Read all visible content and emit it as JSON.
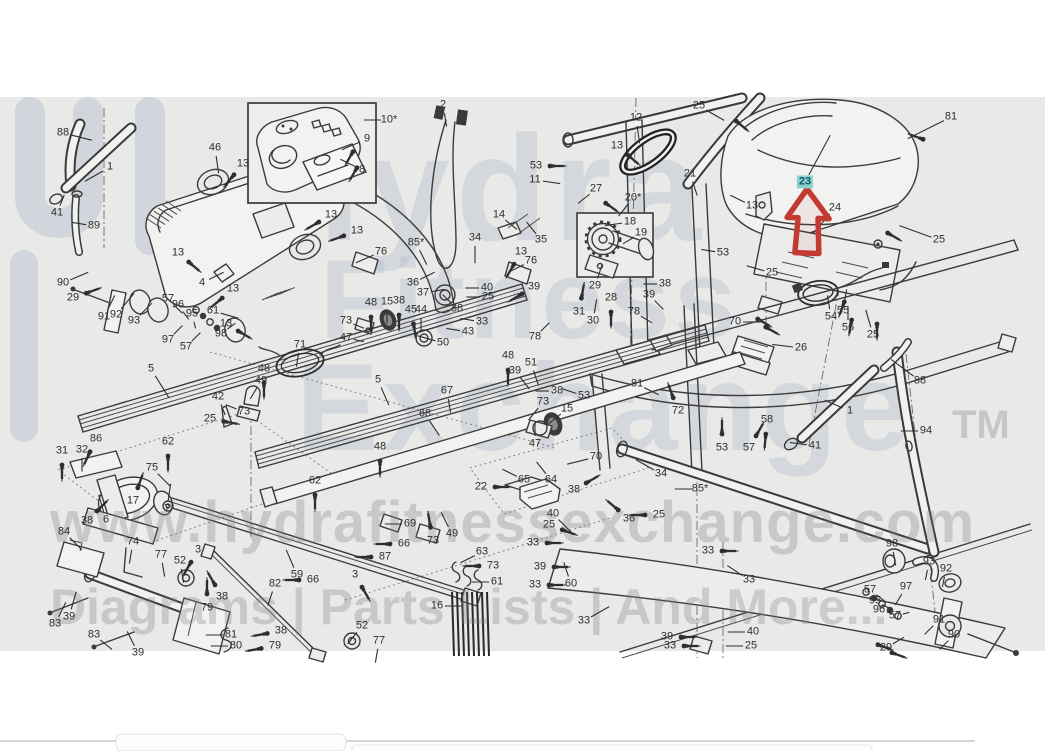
{
  "watermark": {
    "line1": "Hydra",
    "line2": "Fitness",
    "line3": "Exchange",
    "tm": "TM",
    "url": "www.hydrafitnessexchange.com",
    "tagline": "Diagrams | Parts Lists | And More..."
  },
  "highlight": {
    "part": "23",
    "arrow_color": "#c23a31",
    "highlight_bg": "#8bd0cd",
    "highlight_text": "#14586e"
  },
  "colors": {
    "canvas": "#e9e9e7",
    "page": "#ffffff",
    "line": "#3b3b3b",
    "label": "#2e2e2e"
  },
  "callouts": [
    {
      "t": "88",
      "x": 63,
      "y": 133,
      "l": [
        16,
        4
      ]
    },
    {
      "t": "1",
      "x": 110,
      "y": 167,
      "l": [
        -14,
        8
      ]
    },
    {
      "t": "41",
      "x": 57,
      "y": 213,
      "l": [
        4,
        -10
      ]
    },
    {
      "t": "89",
      "x": 94,
      "y": 226,
      "l": [
        -12,
        -2
      ]
    },
    {
      "t": "46",
      "x": 215,
      "y": 148,
      "l": [
        2,
        14
      ]
    },
    {
      "t": "13",
      "x": 243,
      "y": 164,
      "s": 130
    },
    {
      "t": "13",
      "x": 331,
      "y": 215,
      "s": 150
    },
    {
      "t": "13",
      "x": 357,
      "y": 231,
      "s": 160
    },
    {
      "t": "76",
      "x": 381,
      "y": 252,
      "l": [
        -14,
        6
      ]
    },
    {
      "t": "13",
      "x": 178,
      "y": 253,
      "s": 40
    },
    {
      "t": "4",
      "x": 202,
      "y": 283,
      "l": [
        12,
        -6
      ]
    },
    {
      "t": "13",
      "x": 233,
      "y": 289,
      "s": 140
    },
    {
      "t": "61",
      "x": 213,
      "y": 311,
      "l": [
        14,
        4
      ]
    },
    {
      "t": "13",
      "x": 226,
      "y": 324,
      "s": 30
    },
    {
      "t": "10*",
      "x": 389,
      "y": 120,
      "l": [
        -14,
        0
      ]
    },
    {
      "t": "9",
      "x": 367,
      "y": 139,
      "l": [
        -14,
        6
      ]
    },
    {
      "t": "8",
      "x": 362,
      "y": 170,
      "l": [
        -12,
        -6
      ]
    },
    {
      "t": "2",
      "x": 443,
      "y": 105,
      "l": [
        2,
        12
      ]
    },
    {
      "t": "90",
      "x": 63,
      "y": 283,
      "l": [
        14,
        -6
      ]
    },
    {
      "t": "29",
      "x": 73,
      "y": 298,
      "s": -20
    },
    {
      "t": "91",
      "x": 104,
      "y": 317,
      "l": [
        6,
        -12
      ]
    },
    {
      "t": "92",
      "x": 116,
      "y": 315,
      "l": [
        10,
        -12
      ]
    },
    {
      "t": "93",
      "x": 134,
      "y": 321,
      "l": [
        10,
        -10
      ]
    },
    {
      "t": "57",
      "x": 168,
      "y": 299,
      "l": [
        8,
        8
      ]
    },
    {
      "t": "96",
      "x": 178,
      "y": 305,
      "l": [
        6,
        8
      ]
    },
    {
      "t": "95",
      "x": 192,
      "y": 314,
      "l": [
        2,
        8
      ]
    },
    {
      "t": "97",
      "x": 168,
      "y": 340,
      "l": [
        8,
        -8
      ]
    },
    {
      "t": "57",
      "x": 186,
      "y": 347,
      "l": [
        8,
        -8
      ]
    },
    {
      "t": "98",
      "x": 221,
      "y": 334,
      "l": [
        8,
        -6
      ]
    },
    {
      "t": "5",
      "x": 151,
      "y": 369,
      "l": [
        10,
        16
      ]
    },
    {
      "t": "71",
      "x": 300,
      "y": 345,
      "l": [
        -2,
        12
      ]
    },
    {
      "t": "48",
      "x": 264,
      "y": 369,
      "s": 90
    },
    {
      "t": "49",
      "x": 261,
      "y": 381,
      "l": [
        -6,
        10
      ]
    },
    {
      "t": "42",
      "x": 218,
      "y": 397,
      "l": [
        4,
        10
      ]
    },
    {
      "t": "73",
      "x": 244,
      "y": 412,
      "l": [
        -10,
        -4
      ]
    },
    {
      "t": "25",
      "x": 210,
      "y": 419,
      "s": 10
    },
    {
      "t": "62",
      "x": 168,
      "y": 442,
      "s": 90
    },
    {
      "t": "86",
      "x": 96,
      "y": 439,
      "s": 115
    },
    {
      "t": "31",
      "x": 62,
      "y": 451,
      "s": 90
    },
    {
      "t": "32",
      "x": 82,
      "y": 450,
      "l": [
        0,
        12
      ]
    },
    {
      "t": "75",
      "x": 152,
      "y": 468,
      "l": [
        10,
        10
      ]
    },
    {
      "t": "17",
      "x": 133,
      "y": 501,
      "s": -70
    },
    {
      "t": "38",
      "x": 87,
      "y": 521,
      "s": -45
    },
    {
      "t": "6",
      "x": 106,
      "y": 520,
      "l": [
        -4,
        -14
      ]
    },
    {
      "t": "7",
      "x": 167,
      "y": 509,
      "l": [
        2,
        -14
      ]
    },
    {
      "t": "62",
      "x": 315,
      "y": 481,
      "s": 90
    },
    {
      "t": "85*",
      "x": 416,
      "y": 243,
      "l": [
        6,
        12
      ]
    },
    {
      "t": "34",
      "x": 475,
      "y": 238,
      "l": [
        0,
        14
      ]
    },
    {
      "t": "36",
      "x": 413,
      "y": 283,
      "l": [
        12,
        -6
      ]
    },
    {
      "t": "37",
      "x": 423,
      "y": 293,
      "l": [
        12,
        -2
      ]
    },
    {
      "t": "40",
      "x": 487,
      "y": 288,
      "l": [
        -12,
        0
      ]
    },
    {
      "t": "25",
      "x": 488,
      "y": 297,
      "l": [
        -12,
        0
      ]
    },
    {
      "t": "38",
      "x": 457,
      "y": 309,
      "l": [
        -8,
        -8
      ]
    },
    {
      "t": "39",
      "x": 534,
      "y": 287,
      "s": 150
    },
    {
      "t": "33",
      "x": 482,
      "y": 322,
      "l": [
        -12,
        -2
      ]
    },
    {
      "t": "43",
      "x": 468,
      "y": 332,
      "l": [
        -12,
        -2
      ]
    },
    {
      "t": "50",
      "x": 443,
      "y": 343,
      "l": [
        -14,
        -4
      ]
    },
    {
      "t": "48",
      "x": 371,
      "y": 303,
      "s": 90
    },
    {
      "t": "15",
      "x": 387,
      "y": 302,
      "l": [
        0,
        12
      ]
    },
    {
      "t": "38",
      "x": 399,
      "y": 301,
      "s": 90
    },
    {
      "t": "45",
      "x": 411,
      "y": 310,
      "s": 80
    },
    {
      "t": "44",
      "x": 421,
      "y": 310,
      "l": [
        0,
        12
      ]
    },
    {
      "t": "78",
      "x": 535,
      "y": 337,
      "l": [
        8,
        -8
      ]
    },
    {
      "t": "13",
      "x": 521,
      "y": 252,
      "s": 120
    },
    {
      "t": "76",
      "x": 531,
      "y": 261,
      "l": [
        -12,
        6
      ]
    },
    {
      "t": "14",
      "x": 499,
      "y": 215,
      "l": [
        10,
        8
      ]
    },
    {
      "t": "35",
      "x": 541,
      "y": 240,
      "l": [
        -8,
        -10
      ]
    },
    {
      "t": "53",
      "x": 536,
      "y": 166,
      "s": 0
    },
    {
      "t": "11",
      "x": 535,
      "y": 180,
      "l": [
        14,
        2
      ]
    },
    {
      "t": "27",
      "x": 596,
      "y": 189,
      "l": [
        -10,
        8
      ]
    },
    {
      "t": "12",
      "x": 636,
      "y": 118,
      "l": [
        2,
        14
      ]
    },
    {
      "t": "13",
      "x": 617,
      "y": 146,
      "s": 40
    },
    {
      "t": "20*",
      "x": 633,
      "y": 198,
      "l": [
        -8,
        10
      ]
    },
    {
      "t": "18",
      "x": 630,
      "y": 222,
      "l": [
        -14,
        2
      ]
    },
    {
      "t": "19",
      "x": 641,
      "y": 233,
      "l": [
        -10,
        6
      ]
    },
    {
      "t": "29",
      "x": 595,
      "y": 286,
      "l": [
        4,
        -12
      ]
    },
    {
      "t": "38",
      "x": 665,
      "y": 284,
      "l": [
        -12,
        0
      ]
    },
    {
      "t": "31",
      "x": 579,
      "y": 312,
      "s": -80
    },
    {
      "t": "30",
      "x": 593,
      "y": 321,
      "l": [
        2,
        -12
      ]
    },
    {
      "t": "28",
      "x": 611,
      "y": 298,
      "s": 90
    },
    {
      "t": "39",
      "x": 649,
      "y": 295,
      "l": [
        8,
        8
      ]
    },
    {
      "t": "78",
      "x": 634,
      "y": 312,
      "l": [
        10,
        6
      ]
    },
    {
      "t": "21",
      "x": 690,
      "y": 174,
      "l": [
        4,
        12
      ]
    },
    {
      "t": "13",
      "x": 752,
      "y": 206,
      "l": [
        -12,
        -6
      ]
    },
    {
      "t": "53",
      "x": 723,
      "y": 253,
      "l": [
        -12,
        -2
      ]
    },
    {
      "t": "25",
      "x": 772,
      "y": 273,
      "l": [
        -14,
        -4
      ]
    },
    {
      "t": "25",
      "x": 699,
      "y": 106,
      "l": [
        14,
        8
      ]
    },
    {
      "t": "81",
      "x": 951,
      "y": 117,
      "l": [
        -24,
        12
      ]
    },
    {
      "t": "23",
      "x": 805,
      "y": 182,
      "hl": true,
      "l": [
        14,
        -26
      ]
    },
    {
      "t": "24",
      "x": 835,
      "y": 208,
      "l": [
        -12,
        14
      ]
    },
    {
      "t": "25",
      "x": 939,
      "y": 240,
      "l": [
        -22,
        -8
      ]
    },
    {
      "t": "54",
      "x": 831,
      "y": 317,
      "l": [
        -2,
        -12
      ]
    },
    {
      "t": "55",
      "x": 843,
      "y": 311,
      "l": [
        2,
        -12
      ]
    },
    {
      "t": "56",
      "x": 848,
      "y": 328,
      "l": [
        0,
        -12
      ]
    },
    {
      "t": "25",
      "x": 873,
      "y": 335,
      "l": [
        -4,
        -14
      ]
    },
    {
      "t": "70",
      "x": 735,
      "y": 322,
      "l": [
        16,
        0
      ]
    },
    {
      "t": "26",
      "x": 801,
      "y": 348,
      "l": [
        -16,
        -2
      ]
    },
    {
      "t": "88",
      "x": 920,
      "y": 381,
      "l": [
        -16,
        -12
      ]
    },
    {
      "t": "1",
      "x": 850,
      "y": 411,
      "l": [
        -14,
        -6
      ]
    },
    {
      "t": "94",
      "x": 926,
      "y": 431,
      "l": [
        -14,
        0
      ]
    },
    {
      "t": "41",
      "x": 815,
      "y": 446,
      "l": [
        -14,
        -2
      ]
    },
    {
      "t": "58",
      "x": 767,
      "y": 420,
      "s": 95
    },
    {
      "t": "57",
      "x": 749,
      "y": 448,
      "s": -60
    },
    {
      "t": "53",
      "x": 722,
      "y": 448,
      "s": -90
    },
    {
      "t": "72",
      "x": 678,
      "y": 411,
      "s": -110
    },
    {
      "t": "81",
      "x": 637,
      "y": 384,
      "l": [
        12,
        6
      ]
    },
    {
      "t": "85*",
      "x": 700,
      "y": 489,
      "l": [
        -14,
        0
      ]
    },
    {
      "t": "34",
      "x": 661,
      "y": 474,
      "l": [
        -14,
        -8
      ]
    },
    {
      "t": "70",
      "x": 596,
      "y": 457,
      "l": [
        -16,
        4
      ]
    },
    {
      "t": "64",
      "x": 551,
      "y": 480,
      "l": [
        -8,
        -10
      ]
    },
    {
      "t": "65",
      "x": 524,
      "y": 480,
      "l": [
        -12,
        -6
      ]
    },
    {
      "t": "22",
      "x": 481,
      "y": 487,
      "s": 0
    },
    {
      "t": "38",
      "x": 574,
      "y": 490,
      "s": -30
    },
    {
      "t": "47",
      "x": 535,
      "y": 444,
      "l": [
        0,
        -12
      ]
    },
    {
      "t": "73",
      "x": 543,
      "y": 402,
      "l": [
        -8,
        10
      ]
    },
    {
      "t": "15",
      "x": 567,
      "y": 409,
      "l": [
        -10,
        8
      ]
    },
    {
      "t": "53",
      "x": 584,
      "y": 396,
      "l": [
        -12,
        -4
      ]
    },
    {
      "t": "38",
      "x": 557,
      "y": 391,
      "l": [
        -12,
        0
      ]
    },
    {
      "t": "51",
      "x": 531,
      "y": 363,
      "l": [
        4,
        12
      ]
    },
    {
      "t": "39",
      "x": 515,
      "y": 371,
      "l": [
        8,
        10
      ]
    },
    {
      "t": "48",
      "x": 508,
      "y": 356,
      "s": 90
    },
    {
      "t": "48",
      "x": 380,
      "y": 447,
      "s": 90
    },
    {
      "t": "5",
      "x": 378,
      "y": 380,
      "l": [
        6,
        14
      ]
    },
    {
      "t": "67",
      "x": 447,
      "y": 391,
      "l": [
        2,
        12
      ]
    },
    {
      "t": "68",
      "x": 425,
      "y": 414,
      "l": [
        8,
        12
      ]
    },
    {
      "t": "73",
      "x": 346,
      "y": 321,
      "l": [
        10,
        4
      ]
    },
    {
      "t": "47",
      "x": 346,
      "y": 338,
      "l": [
        10,
        2
      ]
    },
    {
      "t": "84",
      "x": 64,
      "y": 532,
      "l": [
        10,
        10
      ]
    },
    {
      "t": "74",
      "x": 133,
      "y": 542,
      "l": [
        -2,
        12
      ]
    },
    {
      "t": "77",
      "x": 161,
      "y": 555,
      "l": [
        2,
        12
      ]
    },
    {
      "t": "52",
      "x": 180,
      "y": 561,
      "l": [
        2,
        12
      ]
    },
    {
      "t": "3",
      "x": 198,
      "y": 550,
      "s": 120
    },
    {
      "t": "59",
      "x": 297,
      "y": 575,
      "l": [
        -6,
        -14
      ]
    },
    {
      "t": "66",
      "x": 313,
      "y": 580,
      "s": 180
    },
    {
      "t": "82",
      "x": 275,
      "y": 584,
      "l": [
        -4,
        12
      ]
    },
    {
      "t": "38",
      "x": 222,
      "y": 597,
      "s": -120
    },
    {
      "t": "79",
      "x": 207,
      "y": 608,
      "s": -90
    },
    {
      "t": "39",
      "x": 69,
      "y": 617,
      "l": [
        4,
        -14
      ]
    },
    {
      "t": "83",
      "x": 55,
      "y": 624,
      "l": [
        6,
        -12
      ]
    },
    {
      "t": "83",
      "x": 94,
      "y": 635,
      "l": [
        10,
        8
      ]
    },
    {
      "t": "39",
      "x": 138,
      "y": 653,
      "l": [
        -6,
        -12
      ]
    },
    {
      "t": "81",
      "x": 231,
      "y": 635,
      "l": [
        -14,
        0
      ]
    },
    {
      "t": "80",
      "x": 236,
      "y": 646,
      "l": [
        -14,
        0
      ]
    },
    {
      "t": "38",
      "x": 281,
      "y": 631,
      "s": 170
    },
    {
      "t": "79",
      "x": 275,
      "y": 646,
      "s": 170
    },
    {
      "t": "69",
      "x": 410,
      "y": 524,
      "l": [
        -14,
        0
      ]
    },
    {
      "t": "73",
      "x": 433,
      "y": 541,
      "s": -100
    },
    {
      "t": "49",
      "x": 452,
      "y": 534,
      "l": [
        -6,
        -12
      ]
    },
    {
      "t": "66",
      "x": 404,
      "y": 544,
      "s": 180
    },
    {
      "t": "87",
      "x": 385,
      "y": 557,
      "s": 180
    },
    {
      "t": "3",
      "x": 355,
      "y": 575,
      "s": 60
    },
    {
      "t": "63",
      "x": 482,
      "y": 552,
      "l": [
        -12,
        6
      ]
    },
    {
      "t": "73",
      "x": 493,
      "y": 566,
      "s": 180
    },
    {
      "t": "61",
      "x": 497,
      "y": 582,
      "l": [
        -14,
        0
      ]
    },
    {
      "t": "16",
      "x": 437,
      "y": 606,
      "l": [
        14,
        0
      ]
    },
    {
      "t": "52",
      "x": 362,
      "y": 626,
      "l": [
        -8,
        10
      ]
    },
    {
      "t": "77",
      "x": 379,
      "y": 641,
      "l": [
        -2,
        12
      ]
    },
    {
      "t": "40",
      "x": 553,
      "y": 514,
      "l": [
        10,
        10
      ]
    },
    {
      "t": "25",
      "x": 549,
      "y": 525,
      "s": 20
    },
    {
      "t": "33",
      "x": 533,
      "y": 543,
      "s": 0
    },
    {
      "t": "39",
      "x": 540,
      "y": 567,
      "s": 0
    },
    {
      "t": "33",
      "x": 535,
      "y": 585,
      "s": 0
    },
    {
      "t": "60",
      "x": 571,
      "y": 584,
      "l": [
        -4,
        -12
      ]
    },
    {
      "t": "33",
      "x": 584,
      "y": 621,
      "l": [
        14,
        -8
      ]
    },
    {
      "t": "36",
      "x": 629,
      "y": 519,
      "s": -140
    },
    {
      "t": "25",
      "x": 659,
      "y": 515,
      "s": 180
    },
    {
      "t": "39",
      "x": 667,
      "y": 637,
      "s": 0
    },
    {
      "t": "33",
      "x": 670,
      "y": 646,
      "s": 0
    },
    {
      "t": "33",
      "x": 708,
      "y": 551,
      "s": 0
    },
    {
      "t": "33",
      "x": 749,
      "y": 580,
      "l": [
        -12,
        -8
      ]
    },
    {
      "t": "40",
      "x": 753,
      "y": 632,
      "l": [
        -14,
        0
      ]
    },
    {
      "t": "25",
      "x": 751,
      "y": 646,
      "l": [
        -14,
        0
      ]
    },
    {
      "t": "98",
      "x": 892,
      "y": 544,
      "l": [
        2,
        12
      ]
    },
    {
      "t": "93",
      "x": 929,
      "y": 562,
      "l": [
        -2,
        10
      ]
    },
    {
      "t": "92",
      "x": 946,
      "y": 569,
      "l": [
        -2,
        10
      ]
    },
    {
      "t": "57",
      "x": 870,
      "y": 590,
      "l": [
        8,
        6
      ]
    },
    {
      "t": "97",
      "x": 906,
      "y": 587,
      "l": [
        -6,
        10
      ]
    },
    {
      "t": "95",
      "x": 875,
      "y": 601,
      "l": [
        8,
        4
      ]
    },
    {
      "t": "96",
      "x": 879,
      "y": 610,
      "l": [
        8,
        2
      ]
    },
    {
      "t": "57",
      "x": 895,
      "y": 616,
      "l": [
        8,
        -2
      ]
    },
    {
      "t": "91",
      "x": 939,
      "y": 620,
      "l": [
        -8,
        8
      ]
    },
    {
      "t": "90",
      "x": 954,
      "y": 635,
      "l": [
        -8,
        8
      ]
    },
    {
      "t": "29",
      "x": 886,
      "y": 648,
      "l": [
        10,
        -6
      ]
    }
  ]
}
